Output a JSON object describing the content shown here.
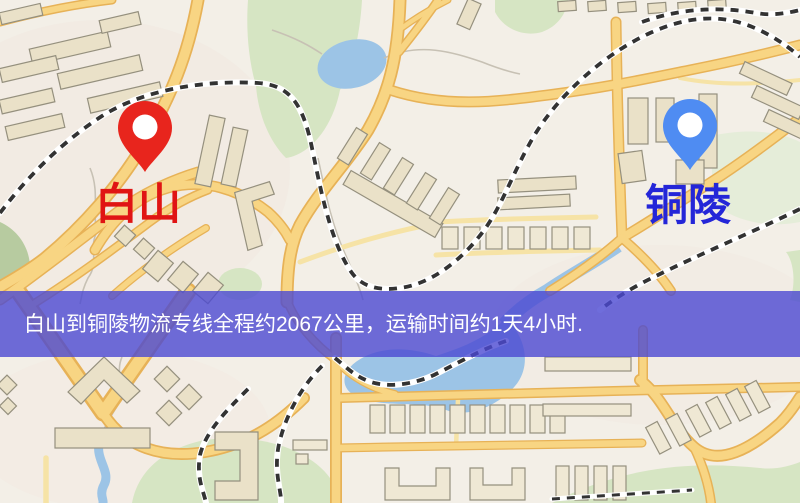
{
  "map": {
    "origin": {
      "label": "白山",
      "pin_color": "#e8251d",
      "label_color": "#e01414"
    },
    "destination": {
      "label": "铜陵",
      "pin_color": "#4f8cf2",
      "label_color": "#2426d8"
    },
    "banner": {
      "text": "白山到铜陵物流专线全程约2067公里，运输时间约1天4小时.",
      "overlay_color": "#4b48d2",
      "text_color": "#ffffff"
    }
  },
  "palette": {
    "background": "#f3efe7",
    "road": "#f8d583",
    "road_casing": "#e7b257",
    "minor_road": "#f6e3a6",
    "water": "#9cc4e6",
    "park": "#d6e5c3",
    "building": "#eae1c8",
    "building_outline": "#95907e",
    "railway": "#333333"
  }
}
